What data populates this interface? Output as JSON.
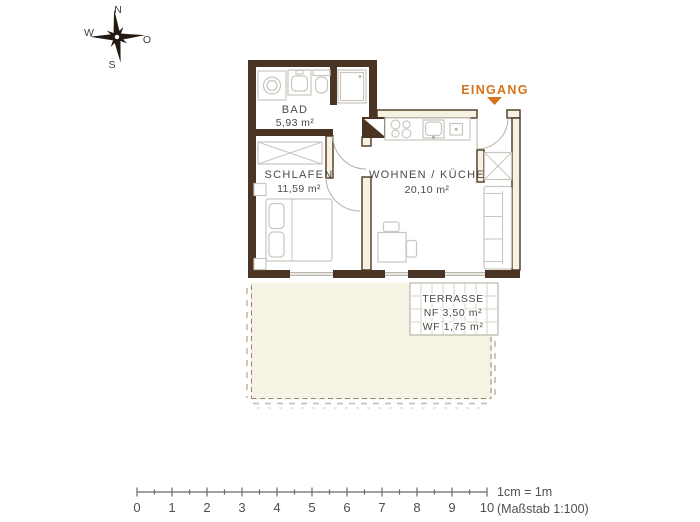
{
  "compass": {
    "n": "N",
    "w": "W",
    "o": "O",
    "s": "S"
  },
  "entrance": {
    "label": "EINGANG"
  },
  "rooms": {
    "bad": {
      "name": "BAD",
      "area": "5,93 m²"
    },
    "schlafen": {
      "name": "SCHLAFEN",
      "area": "11,59 m²"
    },
    "wohnen_kueche": {
      "name": "WOHNEN / KÜCHE",
      "area": "20,10 m²"
    },
    "terrasse": {
      "name": "TERRASSE",
      "nf": "NF 3,50 m²",
      "wf": "WF 1,75 m²"
    }
  },
  "scale_bar": {
    "ticks": [
      "0",
      "1",
      "2",
      "3",
      "4",
      "5",
      "6",
      "7",
      "8",
      "9",
      "10"
    ],
    "legend_line1": "1cm = 1m",
    "legend_line2": "(Maßstab 1:100)"
  },
  "colors": {
    "wall": "#4a3524",
    "wall_light": "#f6f1e1",
    "garden": "#f7f3e4",
    "furniture": "#c9c6bf",
    "text": "#4b4a44",
    "accent_orange": "#d4731c"
  }
}
